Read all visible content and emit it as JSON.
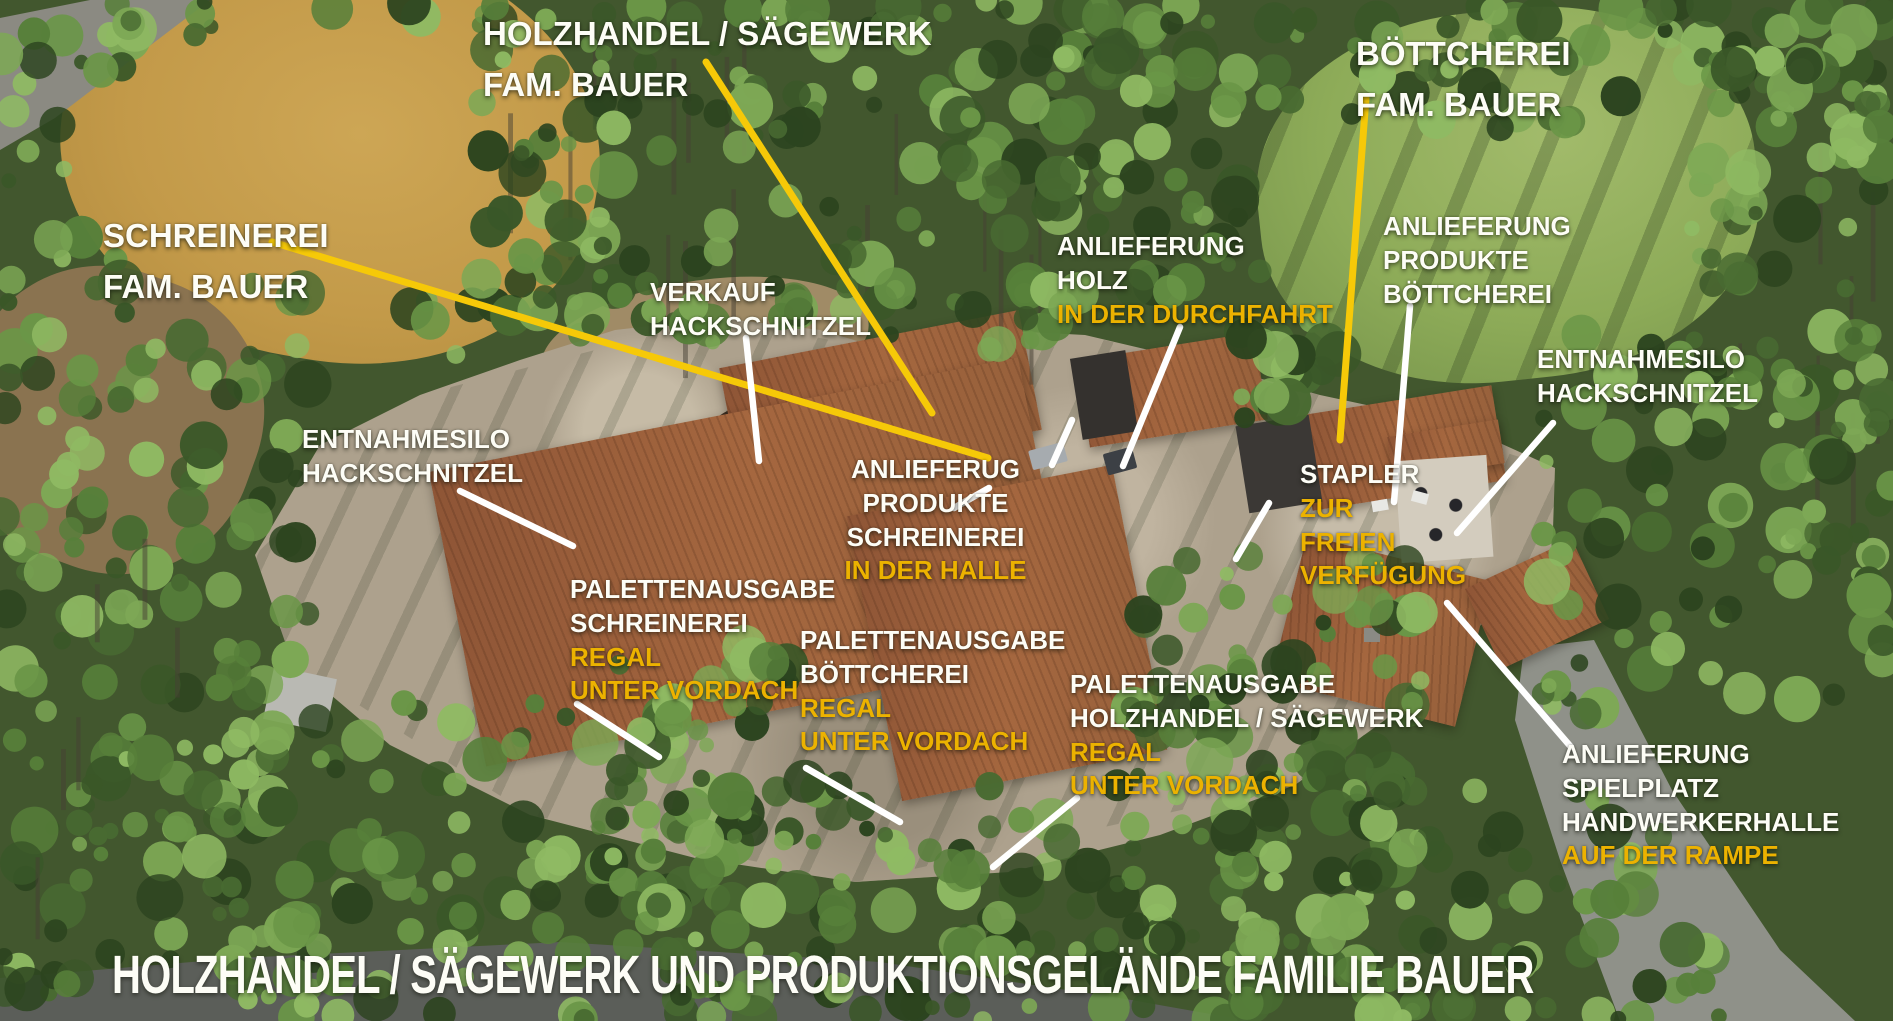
{
  "scene": {
    "bottom_title": "HOLZHANDEL / SÄGEWERK UND PRODUKTIONSGELÄNDE FAMILIE BAUER",
    "colors": {
      "label_white": "#fdfdf6",
      "label_yellow": "#ecb200",
      "line_white": "#ffffff",
      "line_yellow": "#f6c908"
    }
  },
  "labels": {
    "holzhandel_title": {
      "lines": [
        {
          "text": "HOLZHANDEL / SÄGEWERK",
          "color": "white"
        },
        {
          "text": "FAM. BAUER",
          "color": "white"
        }
      ]
    },
    "boettcherei_title": {
      "lines": [
        {
          "text": "BÖTTCHEREI",
          "color": "white"
        },
        {
          "text": "FAM. BAUER",
          "color": "white"
        }
      ]
    },
    "schreinerei_title": {
      "lines": [
        {
          "text": "SCHREINEREI",
          "color": "white"
        },
        {
          "text": "FAM. BAUER",
          "color": "white"
        }
      ]
    },
    "verkauf_hackschnitzel": {
      "lines": [
        {
          "text": "VERKAUF",
          "color": "white"
        },
        {
          "text": "HACKSCHNITZEL",
          "color": "white"
        }
      ]
    },
    "anlieferung_holz": {
      "lines": [
        {
          "text": "ANLIEFERUNG",
          "color": "white"
        },
        {
          "text": "HOLZ",
          "color": "white"
        },
        {
          "text": "IN DER DURCHFAHRT",
          "color": "yellow"
        }
      ]
    },
    "anlieferung_produkte_boettcherei": {
      "lines": [
        {
          "text": "ANLIEFERUNG",
          "color": "white"
        },
        {
          "text": "PRODUKTE",
          "color": "white"
        },
        {
          "text": "BÖTTCHEREI",
          "color": "white"
        }
      ]
    },
    "entnahmesilo_right": {
      "lines": [
        {
          "text": "ENTNAHMESILO",
          "color": "white"
        },
        {
          "text": "HACKSCHNITZEL",
          "color": "white"
        }
      ]
    },
    "entnahmesilo_left": {
      "lines": [
        {
          "text": "ENTNAHMESILO",
          "color": "white"
        },
        {
          "text": "HACKSCHNITZEL",
          "color": "white"
        }
      ]
    },
    "anlieferug_produkte_schreinerei": {
      "lines": [
        {
          "text": "ANLIEFERUG",
          "color": "white"
        },
        {
          "text": "PRODUKTE",
          "color": "white"
        },
        {
          "text": "SCHREINEREI",
          "color": "white"
        },
        {
          "text": "IN DER HALLE",
          "color": "yellow"
        }
      ]
    },
    "stapler": {
      "lines": [
        {
          "text": "STAPLER",
          "color": "white"
        },
        {
          "text": "ZUR",
          "color": "yellow"
        },
        {
          "text": "FREIEN",
          "color": "yellow"
        },
        {
          "text": "VERFÜGUNG",
          "color": "yellow"
        }
      ]
    },
    "palettenausgabe_schreinerei": {
      "lines": [
        {
          "text": "PALETTENAUSGABE",
          "color": "white"
        },
        {
          "text": "SCHREINEREI",
          "color": "white"
        },
        {
          "text": "REGAL",
          "color": "yellow"
        },
        {
          "text": "UNTER VORDACH",
          "color": "yellow"
        }
      ]
    },
    "palettenausgabe_boettcherei": {
      "lines": [
        {
          "text": "PALETTENAUSGABE",
          "color": "white"
        },
        {
          "text": "BÖTTCHEREI",
          "color": "white"
        },
        {
          "text": "REGAL",
          "color": "yellow"
        },
        {
          "text": "UNTER VORDACH",
          "color": "yellow"
        }
      ]
    },
    "palettenausgabe_holzhandel": {
      "lines": [
        {
          "text": "PALETTENAUSGABE",
          "color": "white"
        },
        {
          "text": "HOLZHANDEL / SÄGEWERK",
          "color": "white"
        },
        {
          "text": "REGAL",
          "color": "yellow"
        },
        {
          "text": "UNTER VORDACH",
          "color": "yellow"
        }
      ]
    },
    "anlieferung_spielplatz": {
      "lines": [
        {
          "text": "ANLIEFERUNG",
          "color": "white"
        },
        {
          "text": "SPIELPLATZ",
          "color": "white"
        },
        {
          "text": "HANDWERKERHALLE",
          "color": "white"
        },
        {
          "text": "AUF DER RAMPE",
          "color": "yellow"
        }
      ]
    }
  },
  "annotation_lines": [
    {
      "name": "pointer-schreinerei",
      "color": "yellow",
      "x1": 272,
      "y1": 242,
      "x2": 988,
      "y2": 458
    },
    {
      "name": "pointer-holzhandel",
      "color": "yellow",
      "x1": 706,
      "y1": 62,
      "x2": 932,
      "y2": 413
    },
    {
      "name": "pointer-boettcherei",
      "color": "yellow",
      "x1": 1366,
      "y1": 98,
      "x2": 1340,
      "y2": 440
    },
    {
      "name": "pointer-verkauf-hackschnitzel",
      "color": "white",
      "x1": 746,
      "y1": 338,
      "x2": 759,
      "y2": 461
    },
    {
      "name": "pointer-anlieferung-holz",
      "color": "white",
      "x1": 1180,
      "y1": 327,
      "x2": 1123,
      "y2": 466
    },
    {
      "name": "pointer-anlieferung-holz-2",
      "color": "white",
      "x1": 1072,
      "y1": 420,
      "x2": 1052,
      "y2": 465
    },
    {
      "name": "pointer-anlieferung-produkte-boettcherei",
      "color": "white",
      "x1": 1410,
      "y1": 306,
      "x2": 1394,
      "y2": 502
    },
    {
      "name": "pointer-entnahmesilo-right",
      "color": "white",
      "x1": 1553,
      "y1": 423,
      "x2": 1457,
      "y2": 533
    },
    {
      "name": "pointer-entnahmesilo-left",
      "color": "white",
      "x1": 460,
      "y1": 491,
      "x2": 573,
      "y2": 546
    },
    {
      "name": "pointer-anlieferug-schreinerei",
      "color": "white",
      "x1": 954,
      "y1": 508,
      "x2": 989,
      "y2": 488
    },
    {
      "name": "pointer-stapler",
      "color": "white",
      "x1": 1269,
      "y1": 503,
      "x2": 1236,
      "y2": 559
    },
    {
      "name": "pointer-palettenausgabe-schreinerei",
      "color": "white",
      "x1": 577,
      "y1": 704,
      "x2": 659,
      "y2": 757
    },
    {
      "name": "pointer-palettenausgabe-boettcherei",
      "color": "white",
      "x1": 806,
      "y1": 768,
      "x2": 900,
      "y2": 822
    },
    {
      "name": "pointer-palettenausgabe-holzhandel",
      "color": "white",
      "x1": 1077,
      "y1": 798,
      "x2": 993,
      "y2": 867
    },
    {
      "name": "pointer-anlieferung-spielplatz",
      "color": "white",
      "x1": 1571,
      "y1": 747,
      "x2": 1447,
      "y2": 603
    }
  ]
}
